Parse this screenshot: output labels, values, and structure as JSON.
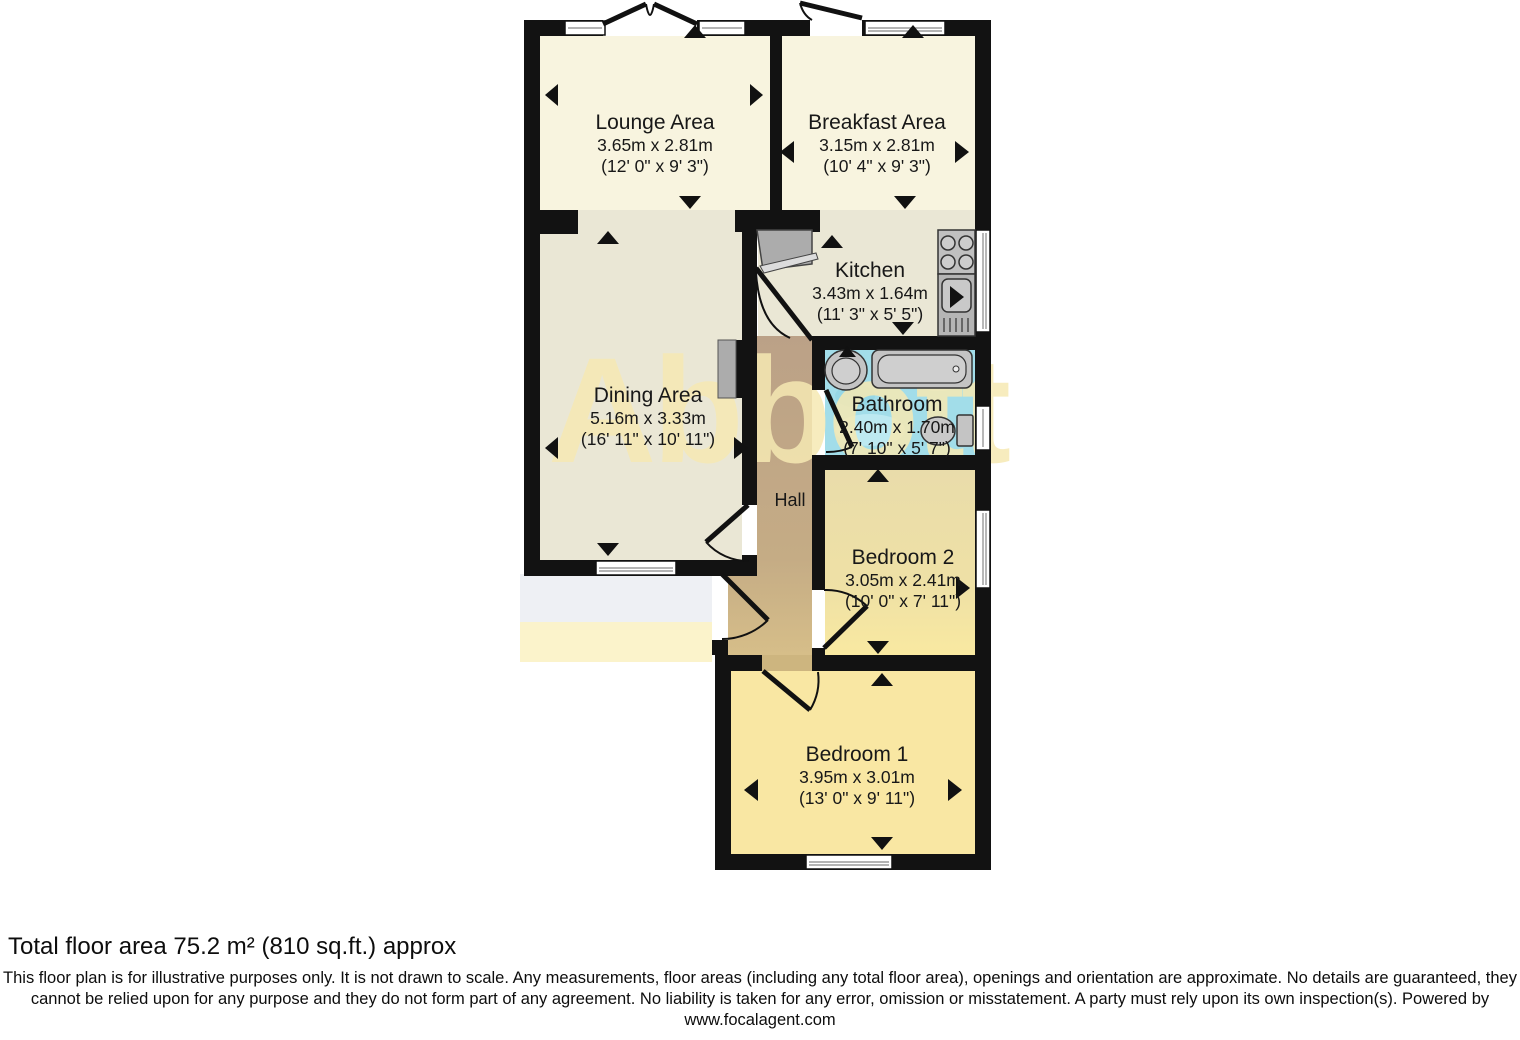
{
  "watermark": "Abbott",
  "rooms": {
    "lounge": {
      "name": "Lounge Area",
      "metric": "3.65m x 2.81m",
      "imperial": "(12' 0\" x 9' 3\")"
    },
    "breakfast": {
      "name": "Breakfast Area",
      "metric": "3.15m x 2.81m",
      "imperial": "(10' 4\" x 9' 3\")"
    },
    "kitchen": {
      "name": "Kitchen",
      "metric": "3.43m x 1.64m",
      "imperial": "(11' 3\" x 5' 5\")"
    },
    "dining": {
      "name": "Dining Area",
      "metric": "5.16m x 3.33m",
      "imperial": "(16' 11\" x 10' 11\")"
    },
    "bathroom": {
      "name": "Bathroom",
      "metric": "2.40m x 1.70m",
      "imperial": "(7' 10\" x 5' 7\")"
    },
    "hall": {
      "name": "Hall"
    },
    "bedroom2": {
      "name": "Bedroom 2",
      "metric": "3.05m x 2.41m",
      "imperial": "(10' 0\" x 7' 11\")"
    },
    "bedroom1": {
      "name": "Bedroom 1",
      "metric": "3.95m x 3.01m",
      "imperial": "(13' 0\" x 9' 11\")"
    }
  },
  "footer": {
    "total_area": "Total floor area 75.2 m² (810 sq.ft.) approx",
    "disclaimer": "This floor plan is for illustrative purposes only. It is not drawn to scale. Any measurements, floor areas (including any total floor area), openings and orientation are approximate. No details are guaranteed, they cannot be relied upon for any purpose and they do not form part of any agreement. No liability is taken for any error, omission or misstatement. A party must rely upon its own inspection(s). Powered by www.focalagent.com"
  },
  "colors": {
    "wall": "#121212",
    "floor_cream": "#F8F4DF",
    "floor_green": "#EAE7D5",
    "floor_hall_top": "#BBA187",
    "floor_hall_bottom": "#D6BE89",
    "floor_bathroom": "#A2DDE9",
    "floor_bedroom": "#F9E7A3",
    "watermark": "#F6E9B3",
    "fixture_gray": "#ACACAC"
  }
}
